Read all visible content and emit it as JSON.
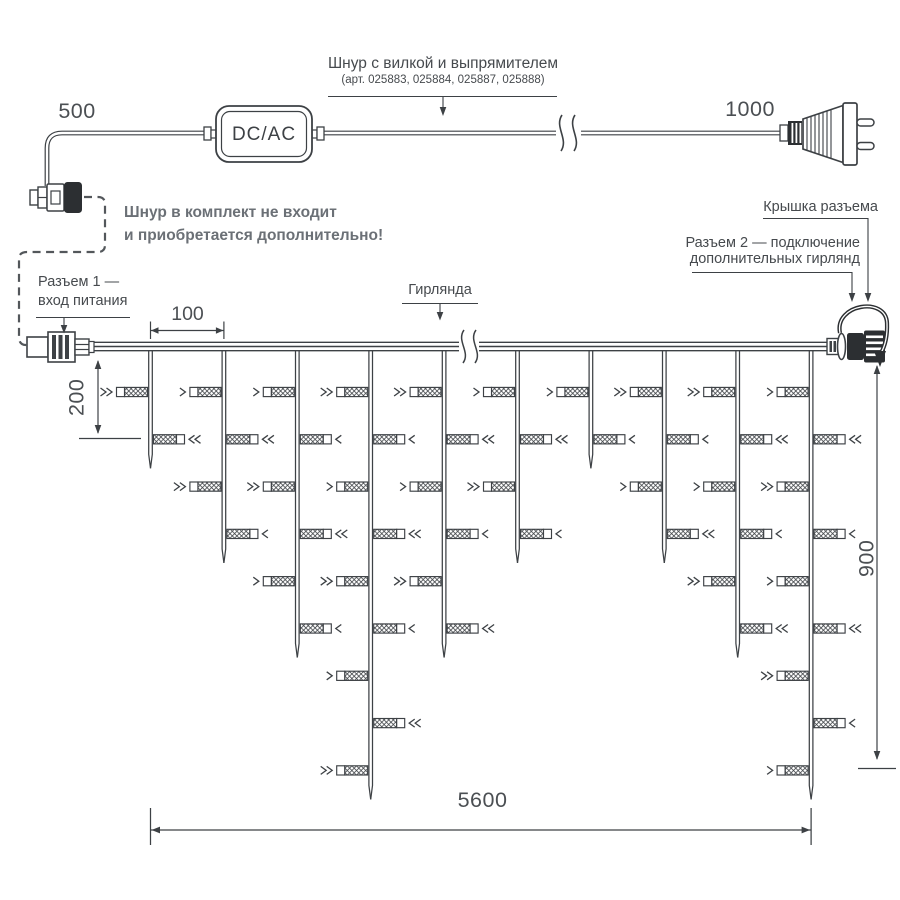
{
  "colors": {
    "ink": "#3d4145",
    "muted_text": "#6b7076",
    "label_text": "#464a4e"
  },
  "power_cord": {
    "title": "Шнур с вилкой и выпрямителем",
    "articles": "(арт. 025883, 025884, 025887, 025888)",
    "converter": "DC/AC",
    "dim_connector_to_converter": "500",
    "dim_converter_to_plug": "1000",
    "note_line1": "Шнур в комплект не входит",
    "note_line2": "и приобретается дополнительно!"
  },
  "garland": {
    "title": "Гирлянда",
    "connector1_label_line1": "Разъем 1 —",
    "connector1_label_line2": "вход питания",
    "connector2_label_line1": "Разъем 2 — подключение",
    "connector2_label_line2": "дополнительных гирлянд",
    "cap_label": "Крышка разъема",
    "dims": {
      "drop_spacing": "100",
      "first_drop": "200",
      "drop_max_length": "900",
      "total_length": "5600"
    },
    "drops": {
      "start_x": 150.5,
      "spacing_x": 73.4,
      "wire_y": 346.5,
      "first_bulb_dy": 45.5,
      "bulb_dy": 47.3,
      "tip_extra": 29,
      "bulb_counts": [
        2,
        4,
        6,
        9,
        6,
        4,
        2,
        4,
        6,
        9
      ]
    }
  }
}
